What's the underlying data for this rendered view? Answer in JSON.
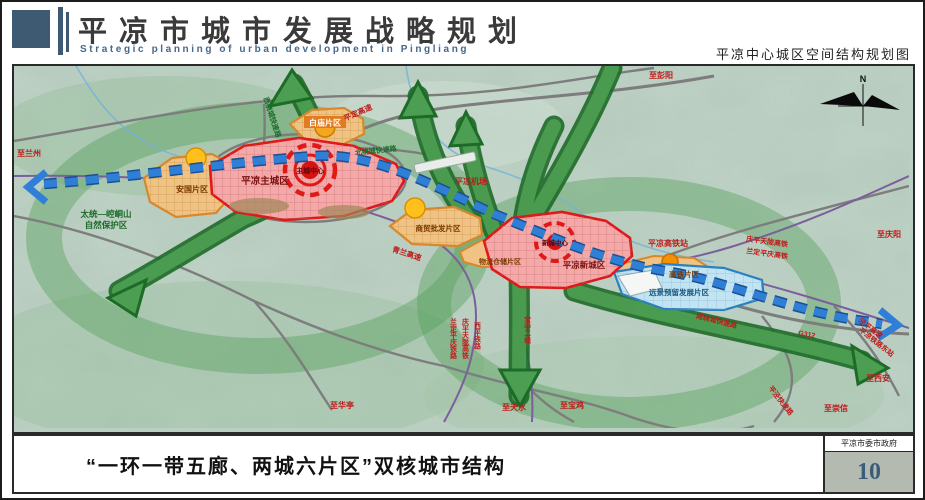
{
  "header": {
    "title_cn": "平凉市城市发展战略规划",
    "title_en": "Strategic planning of urban development in Pingliang",
    "subtitle": "平凉中心城区空间结构规划图"
  },
  "footer": {
    "caption": "“一环一带五廊、两城六片区”双核城市结构",
    "gov": "平凉市委市政府",
    "page": "10"
  },
  "map": {
    "compass": "N",
    "zones": {
      "main_city": "平凉主城区",
      "main_center": "主城中心",
      "new_city": "平凉新城区",
      "new_center": "新城中心",
      "anguo": "安国片区",
      "baimiao": "白庙片区",
      "trade": "商贸批发片区",
      "logistics": "物流仓储片区",
      "hsr": "高铁片区",
      "reserved": "远景预留发展片区"
    },
    "roads": {
      "pingding": "平定高速",
      "qinglan": "青兰高速",
      "west_ring": "西绕城快速路",
      "north_ring": "北绕城快速路",
      "south_ring": "南绕城快速路",
      "pingjing": "平泾快速路",
      "g312": "G312",
      "jingping": "泾平高速",
      "east_station": "平凉铁路东站"
    },
    "railways": {
      "ne1": "庆平天陇高铁",
      "ne2": "兰定平庆高铁",
      "v1": "兰定平庆铁路",
      "v2": "庆平天陇高铁",
      "v3": "西平铁路",
      "baozhong": "宝中二线"
    },
    "places": {
      "airport": "平凉机场",
      "hsr_station": "平凉高铁站",
      "nature1": "太统—崆峒山",
      "nature2": "自然保护区"
    },
    "destinations": {
      "lanzhou": "至兰州",
      "pengyang": "至彭阳",
      "qingyang": "至庆阳",
      "xian": "至西安",
      "chongxin": "至崇信",
      "huating": "至华亭",
      "tianshui": "至天水",
      "baoji": "至宝鸡"
    },
    "colors": {
      "header_blue": "#3e5a72",
      "zone_red": "#e01818",
      "zone_orange": "#d8882a",
      "belt_blue": "#2a6fc9",
      "corridor_green": "#2e7d32",
      "reserved_blue": "#2a7fbf"
    }
  }
}
